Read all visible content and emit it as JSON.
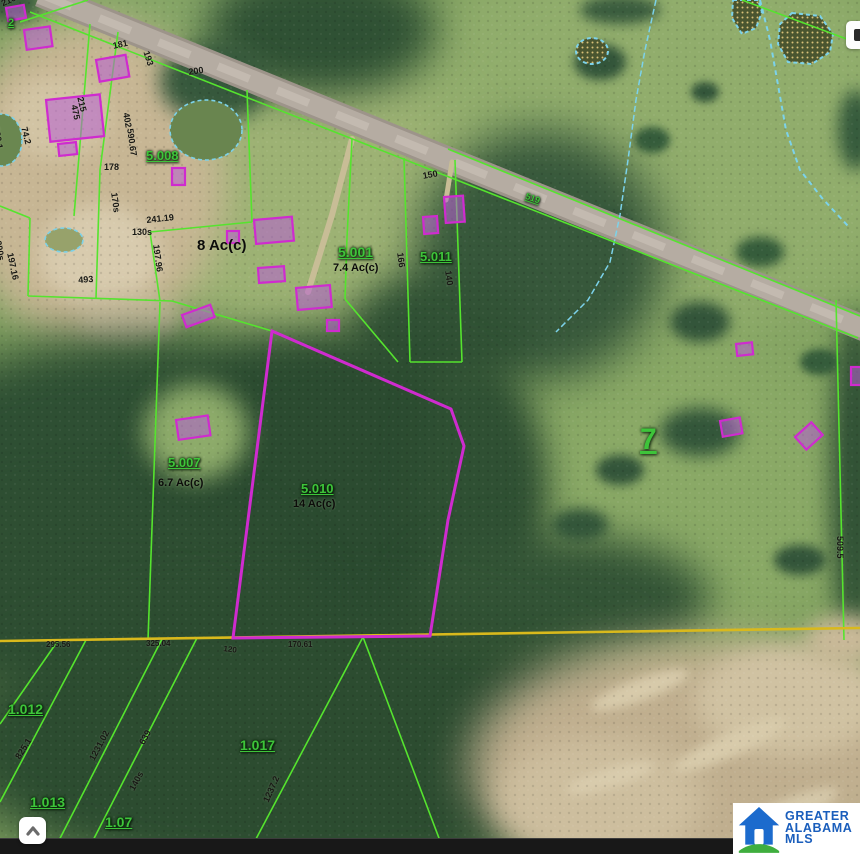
{
  "page": {
    "width": 860,
    "height": 854,
    "description": "Aerial parcel map with GIS overlay"
  },
  "logo": {
    "line1": "GREATER",
    "line2": "ALABAMA",
    "line3": "MLS",
    "brand_blue": "#1a5ebc",
    "brand_green": "#3fae3e"
  },
  "icons": {
    "scroll_to_top": "chevron-up-icon",
    "map_control": "panel-handle-icon",
    "brand": "house-icon"
  },
  "map": {
    "colors": {
      "parcel_line": "#55e42e",
      "subject": "#cf2bcf",
      "section_line": "#d9b91c",
      "water": "#7cd2ea",
      "building_fill": "rgba(182,95,212,0.55)",
      "label_green": "#3ec43a",
      "label_dark": "#181814",
      "field_base": "#7fa05f"
    },
    "terrain": {
      "base": "#7fa05f",
      "blobs": [
        {
          "x": 660,
          "y": 140,
          "rx": 280,
          "ry": 210,
          "f": "#91ad6c",
          "b": 30
        },
        {
          "x": 640,
          "y": 490,
          "rx": 250,
          "ry": 160,
          "f": "#8aa966",
          "b": 30
        },
        {
          "x": 300,
          "y": 200,
          "rx": 175,
          "ry": 150,
          "f": "#9db274",
          "b": 28
        },
        {
          "x": 170,
          "y": 20,
          "rx": 130,
          "ry": 45,
          "f": "#88a768",
          "b": 18
        },
        {
          "x": 90,
          "y": 180,
          "rx": 135,
          "ry": 160,
          "f": "#c7b694",
          "b": 18
        },
        {
          "x": 100,
          "y": 255,
          "rx": 62,
          "ry": 50,
          "f": "#d8cbae",
          "b": 10
        },
        {
          "x": 58,
          "y": 118,
          "rx": 52,
          "ry": 42,
          "f": "#d2c4a4",
          "b": 10
        },
        {
          "x": 130,
          "y": 320,
          "rx": 50,
          "ry": 25,
          "f": "#cfc1a1",
          "b": 10
        },
        {
          "x": 320,
          "y": 30,
          "rx": 115,
          "ry": 65,
          "f": "#2f5134",
          "b": 20
        },
        {
          "x": 215,
          "y": 82,
          "rx": 55,
          "ry": 40,
          "f": "#36583c",
          "b": 10
        },
        {
          "x": 10,
          "y": 2,
          "rx": 32,
          "ry": 20,
          "f": "#3a5a3d",
          "b": 8
        },
        {
          "x": 540,
          "y": 255,
          "rx": 125,
          "ry": 125,
          "f": "#37583b",
          "b": 22
        },
        {
          "x": 440,
          "y": 330,
          "rx": 90,
          "ry": 60,
          "f": "#315235",
          "b": 18
        },
        {
          "x": 150,
          "y": 460,
          "rx": 265,
          "ry": 125,
          "f": "#2e4f33",
          "b": 24
        },
        {
          "x": 340,
          "y": 500,
          "rx": 185,
          "ry": 170,
          "f": "#2b4b30",
          "b": 22
        },
        {
          "x": 100,
          "y": 600,
          "rx": 210,
          "ry": 105,
          "f": "#2e4e32",
          "b": 22
        },
        {
          "x": 480,
          "y": 490,
          "rx": 65,
          "ry": 130,
          "f": "#2f5033",
          "b": 18
        },
        {
          "x": 560,
          "y": 600,
          "rx": 150,
          "ry": 65,
          "f": "#335436",
          "b": 20
        },
        {
          "x": 300,
          "y": 745,
          "rx": 350,
          "ry": 145,
          "f": "#2c4c30",
          "b": 25
        },
        {
          "x": 855,
          "y": 480,
          "rx": 25,
          "ry": 170,
          "f": "#305135",
          "b": 12
        },
        {
          "x": 196,
          "y": 432,
          "rx": 52,
          "ry": 48,
          "f": "#8dab6a",
          "b": 12
        },
        {
          "x": 700,
          "y": 765,
          "rx": 230,
          "ry": 125,
          "f": "#c0af8f",
          "b": 22
        },
        {
          "x": 790,
          "y": 700,
          "rx": 95,
          "ry": 55,
          "f": "#d0c2a2",
          "b": 12
        },
        {
          "x": 600,
          "y": 800,
          "rx": 105,
          "ry": 62,
          "f": "#cdbe9e",
          "b": 14
        },
        {
          "x": 640,
          "y": 690,
          "rx": 52,
          "ry": 11,
          "f": "#d8cbab",
          "b": 5,
          "rot": -20
        },
        {
          "x": 730,
          "y": 745,
          "rx": 62,
          "ry": 12,
          "f": "#d8cbab",
          "b": 5,
          "rot": -24
        },
        {
          "x": 610,
          "y": 778,
          "rx": 46,
          "ry": 10,
          "f": "#d9ccad",
          "b": 5,
          "rot": -16
        },
        {
          "x": 790,
          "y": 810,
          "rx": 52,
          "ry": 12,
          "f": "#d5c8a9",
          "b": 5,
          "rot": -22
        },
        {
          "x": 845,
          "y": 640,
          "rx": 40,
          "ry": 25,
          "f": "#c9b998",
          "b": 10
        },
        {
          "x": 600,
          "y": 62,
          "rx": 26,
          "ry": 18,
          "f": "#33553a",
          "b": 5
        },
        {
          "x": 652,
          "y": 140,
          "rx": 18,
          "ry": 13,
          "f": "#355c3b",
          "b": 4
        },
        {
          "x": 705,
          "y": 92,
          "rx": 14,
          "ry": 10,
          "f": "#33553a",
          "b": 4
        },
        {
          "x": 610,
          "y": 222,
          "rx": 20,
          "ry": 13,
          "f": "#33553a",
          "b": 4
        },
        {
          "x": 760,
          "y": 252,
          "rx": 24,
          "ry": 15,
          "f": "#355c3b",
          "b": 5
        },
        {
          "x": 700,
          "y": 322,
          "rx": 30,
          "ry": 20,
          "f": "#33553a",
          "b": 6
        },
        {
          "x": 820,
          "y": 362,
          "rx": 20,
          "ry": 13,
          "f": "#355c3b",
          "b": 4
        },
        {
          "x": 700,
          "y": 432,
          "rx": 40,
          "ry": 24,
          "f": "#33563a",
          "b": 8
        },
        {
          "x": 620,
          "y": 470,
          "rx": 24,
          "ry": 15,
          "f": "#33553a",
          "b": 5
        },
        {
          "x": 580,
          "y": 525,
          "rx": 28,
          "ry": 16,
          "f": "#33563a",
          "b": 6
        },
        {
          "x": 800,
          "y": 560,
          "rx": 26,
          "ry": 15,
          "f": "#33553a",
          "b": 5
        },
        {
          "x": 856,
          "y": 130,
          "rx": 18,
          "ry": 40,
          "f": "#355a3c",
          "b": 8
        },
        {
          "x": 620,
          "y": 10,
          "rx": 40,
          "ry": 14,
          "f": "#3a5c3e",
          "b": 6
        }
      ]
    },
    "roads": [
      {
        "d": "M40,-6 L868,330",
        "c": "#9d948a",
        "w": 26
      },
      {
        "d": "M40,-6 L868,330",
        "c": "#b5aca2",
        "w": 20
      },
      {
        "d": "M40,-6 L868,330",
        "c": "#c3bab0",
        "w": 8,
        "dash": "34 30"
      }
    ],
    "driveways": [
      {
        "pts": "352,139 332,215 308,292",
        "c": "#c8bd96",
        "w": 6
      },
      {
        "pts": "452,162 446,200",
        "c": "#c8bd96",
        "w": 5
      }
    ],
    "ponds": [
      {
        "e": 1,
        "x": 206,
        "y": 130,
        "rx": 36,
        "ry": 30,
        "f": "#69854f"
      },
      {
        "e": 1,
        "x": 2,
        "y": 140,
        "rx": 20,
        "ry": 26,
        "f": "#6a8750"
      },
      {
        "e": 1,
        "x": 64,
        "y": 240,
        "rx": 19,
        "ry": 12,
        "f": "#97a26b"
      },
      {
        "e": 1,
        "x": 592,
        "y": 51,
        "rx": 16,
        "ry": 13,
        "dots": 1,
        "sw": 2
      },
      {
        "pts": "733,0 758,0 762,12 756,28 742,34 732,18",
        "dots": 1,
        "sw": 2
      },
      {
        "pts": "792,13 820,16 833,34 830,52 812,64 788,62 778,44 780,24",
        "dots": 1,
        "sw": 2
      }
    ],
    "streams": [
      {
        "pts": "656,0 645,50 636,100 628,160 620,215 610,262 588,300 556,332",
        "w": 1.5,
        "dash": "6 3"
      },
      {
        "pts": "760,0 770,40 778,85 786,130 800,170 822,198 848,226",
        "w": 2,
        "dash": "5 4"
      }
    ],
    "lines": [
      {
        "pts": "30,12 858,338"
      },
      {
        "pts": "448,149 860,316"
      },
      {
        "pts": "88,0 20,22"
      },
      {
        "pts": "118,32 100,170 96,298"
      },
      {
        "pts": "90,24 74,216"
      },
      {
        "pts": "28,296 172,301"
      },
      {
        "pts": "30,218 28,296"
      },
      {
        "pts": "0,206 30,218"
      },
      {
        "pts": "247,90 252,222"
      },
      {
        "pts": "252,222 150,232"
      },
      {
        "pts": "150,232 160,301"
      },
      {
        "pts": "172,301 272,331"
      },
      {
        "pts": "160,302 148,640"
      },
      {
        "pts": "352,139 347,238 345,299"
      },
      {
        "pts": "345,299 398,362"
      },
      {
        "pts": "404,158 410,362"
      },
      {
        "pts": "455,160 462,362"
      },
      {
        "pts": "410,362 462,362"
      },
      {
        "pts": "836,300 844,640"
      },
      {
        "pts": "742,0 860,44"
      },
      {
        "pts": "57,642 0,724"
      },
      {
        "pts": "86,640 0,802"
      },
      {
        "pts": "162,639 52,854"
      },
      {
        "pts": "197,638 86,854"
      },
      {
        "pts": "363,637 248,854"
      },
      {
        "pts": "363,637 445,854"
      },
      {
        "pts": "0,641 860,628",
        "c": "#d9b91c",
        "w": 2.6,
        "n": "section-line"
      }
    ],
    "subject_parcel": {
      "pts": "272,331 451,409 464,446 448,520 430,636 233,638",
      "w": 3
    },
    "buildings": [
      {
        "x": 6,
        "y": 8,
        "w": 18,
        "h": 13,
        "r": -10
      },
      {
        "x": 24,
        "y": 30,
        "w": 26,
        "h": 20,
        "r": -8
      },
      {
        "x": 96,
        "y": 60,
        "w": 30,
        "h": 22,
        "r": -10
      },
      {
        "x": 46,
        "y": 100,
        "w": 54,
        "h": 42,
        "r": -6
      },
      {
        "x": 58,
        "y": 144,
        "w": 18,
        "h": 12,
        "r": -6
      },
      {
        "x": 172,
        "y": 168,
        "w": 13,
        "h": 17,
        "r": 0
      },
      {
        "x": 227,
        "y": 231,
        "w": 12,
        "h": 12,
        "r": 0
      },
      {
        "x": 254,
        "y": 220,
        "w": 38,
        "h": 24,
        "r": -5
      },
      {
        "x": 258,
        "y": 268,
        "w": 26,
        "h": 15,
        "r": -4
      },
      {
        "x": 296,
        "y": 288,
        "w": 34,
        "h": 22,
        "r": -5
      },
      {
        "x": 327,
        "y": 320,
        "w": 12,
        "h": 11,
        "r": 0
      },
      {
        "x": 182,
        "y": 315,
        "w": 30,
        "h": 13,
        "r": -20
      },
      {
        "x": 176,
        "y": 420,
        "w": 32,
        "h": 20,
        "r": -8
      },
      {
        "x": 444,
        "y": 197,
        "w": 19,
        "h": 26,
        "r": -4
      },
      {
        "x": 423,
        "y": 217,
        "w": 14,
        "h": 17,
        "r": -4
      },
      {
        "x": 736,
        "y": 344,
        "w": 16,
        "h": 12,
        "r": -6
      },
      {
        "x": 720,
        "y": 421,
        "w": 20,
        "h": 16,
        "r": -10
      },
      {
        "x": 795,
        "y": 437,
        "w": 22,
        "h": 17,
        "r": -42
      },
      {
        "x": 851,
        "y": 367,
        "w": 12,
        "h": 18,
        "r": 0
      }
    ],
    "labels": [
      {
        "t": "5.008",
        "x": 146,
        "y": 149,
        "s": 13,
        "k": "p"
      },
      {
        "t": "5.001",
        "x": 338,
        "y": 245,
        "s": 14,
        "k": "p"
      },
      {
        "t": "5.011",
        "x": 420,
        "y": 250,
        "s": 13,
        "k": "p"
      },
      {
        "t": "5.007",
        "x": 168,
        "y": 456,
        "s": 13,
        "k": "p"
      },
      {
        "t": "5.010",
        "x": 301,
        "y": 482,
        "s": 13,
        "k": "p"
      },
      {
        "t": "1.012",
        "x": 8,
        "y": 702,
        "s": 14,
        "k": "p"
      },
      {
        "t": "1.013",
        "x": 30,
        "y": 795,
        "s": 14,
        "k": "p"
      },
      {
        "t": "1.017",
        "x": 240,
        "y": 738,
        "s": 14,
        "k": "p"
      },
      {
        "t": "1.07",
        "x": 105,
        "y": 815,
        "s": 14,
        "k": "p"
      },
      {
        "t": "519",
        "x": 527,
        "y": 192,
        "s": 9,
        "r": 19,
        "k": "p"
      },
      {
        "t": "2",
        "x": 8,
        "y": 18,
        "s": 11,
        "k": "p"
      },
      {
        "t": "7",
        "x": 640,
        "y": 425,
        "s": 30,
        "k": "s"
      },
      {
        "t": "8 Ac(c)",
        "x": 197,
        "y": 238,
        "s": 15,
        "k": "a"
      },
      {
        "t": "7.4 Ac(c)",
        "x": 333,
        "y": 263,
        "s": 11,
        "k": "a"
      },
      {
        "t": "14 Ac(c)",
        "x": 293,
        "y": 499,
        "s": 11,
        "k": "a"
      },
      {
        "t": "6.7 Ac(c)",
        "x": 158,
        "y": 478,
        "s": 11,
        "k": "a"
      },
      {
        "t": "200",
        "x": 188,
        "y": 68,
        "r": -8,
        "k": "d"
      },
      {
        "t": "215",
        "x": 84,
        "y": 96,
        "r": 76,
        "k": "d"
      },
      {
        "t": "181",
        "x": 112,
        "y": 42,
        "r": -12,
        "k": "d"
      },
      {
        "t": "193",
        "x": 150,
        "y": 50,
        "r": 72,
        "k": "d"
      },
      {
        "t": "216",
        "x": 0,
        "y": 0,
        "r": -25,
        "k": "d"
      },
      {
        "t": "475",
        "x": 78,
        "y": 104,
        "r": 78,
        "k": "d"
      },
      {
        "t": "402",
        "x": 130,
        "y": 112,
        "r": 80,
        "k": "d"
      },
      {
        "t": "590.67",
        "x": 134,
        "y": 128,
        "r": 82,
        "k": "d"
      },
      {
        "t": "178",
        "x": 104,
        "y": 163,
        "k": "d"
      },
      {
        "t": "170s",
        "x": 118,
        "y": 192,
        "r": 82,
        "k": "d"
      },
      {
        "t": "241.19",
        "x": 146,
        "y": 216,
        "r": -6,
        "k": "d"
      },
      {
        "t": "130s",
        "x": 132,
        "y": 228,
        "k": "d"
      },
      {
        "t": "197.96",
        "x": 160,
        "y": 244,
        "r": 82,
        "k": "d"
      },
      {
        "t": "493",
        "x": 78,
        "y": 276,
        "r": -4,
        "k": "d"
      },
      {
        "t": "200s",
        "x": 2,
        "y": 240,
        "r": 80,
        "k": "d"
      },
      {
        "t": "197.16",
        "x": 14,
        "y": 252,
        "r": 78,
        "k": "d"
      },
      {
        "t": "530.1",
        "x": 0,
        "y": 126,
        "r": 80,
        "k": "d"
      },
      {
        "t": "74.2",
        "x": 28,
        "y": 126,
        "r": 76,
        "k": "d"
      },
      {
        "t": "150",
        "x": 422,
        "y": 172,
        "r": -10,
        "k": "d"
      },
      {
        "t": "166",
        "x": 404,
        "y": 252,
        "r": 82,
        "k": "d"
      },
      {
        "t": "140",
        "x": 452,
        "y": 270,
        "r": 82,
        "k": "d"
      },
      {
        "t": "295.56",
        "x": 46,
        "y": 641,
        "s": 8,
        "k": "d"
      },
      {
        "t": "325.04",
        "x": 146,
        "y": 640,
        "s": 8,
        "k": "d"
      },
      {
        "t": "120",
        "x": 224,
        "y": 645,
        "s": 8,
        "r": 8,
        "k": "d"
      },
      {
        "t": "170.61",
        "x": 288,
        "y": 641,
        "s": 8,
        "k": "d"
      },
      {
        "t": "509.5",
        "x": 844,
        "y": 536,
        "r": 90,
        "k": "d"
      },
      {
        "t": "825.1",
        "x": 14,
        "y": 756,
        "r": -58,
        "k": "d"
      },
      {
        "t": "1231.02",
        "x": 88,
        "y": 758,
        "r": -62,
        "k": "d"
      },
      {
        "t": "639",
        "x": 138,
        "y": 742,
        "r": -62,
        "k": "d"
      },
      {
        "t": "140s",
        "x": 128,
        "y": 788,
        "r": -62,
        "k": "d"
      },
      {
        "t": "1237.2",
        "x": 262,
        "y": 800,
        "r": -66,
        "k": "d"
      }
    ]
  }
}
